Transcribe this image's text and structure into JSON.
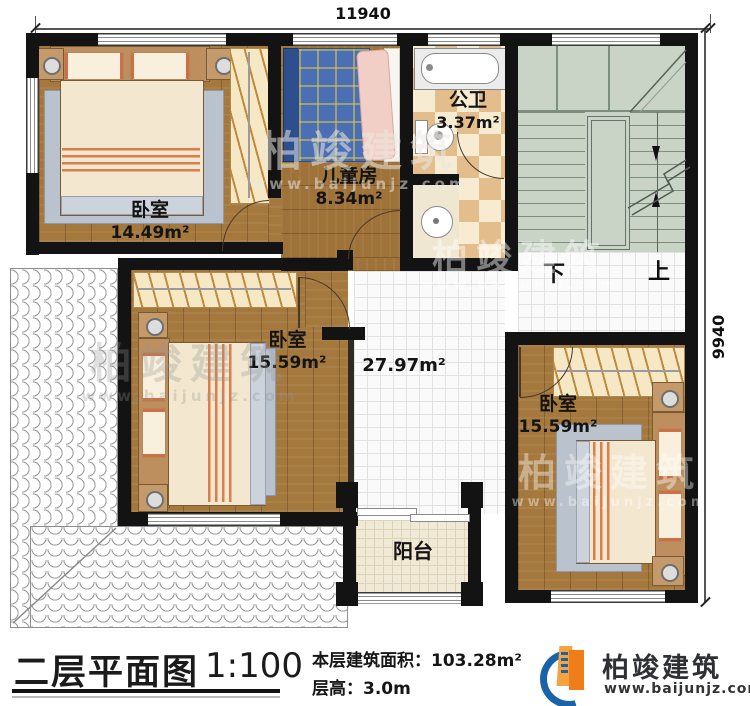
{
  "dimensions": {
    "top": "11940",
    "right": "9940"
  },
  "rooms": {
    "bedroom_top_left": {
      "name": "卧室",
      "area": "14.49m²"
    },
    "kids_room": {
      "name": "儿童房",
      "area": "8.34m²"
    },
    "bathroom": {
      "name": "公卫",
      "area": "3.37m²"
    },
    "bedroom_mid": {
      "name": "卧室",
      "area": "15.59m²"
    },
    "bedroom_right": {
      "name": "卧室",
      "area": "15.59m²"
    },
    "hall": {
      "area": "27.97m²"
    },
    "balcony": {
      "name": "阳台"
    },
    "stairs": {
      "down_label": "下",
      "up_label": "上"
    }
  },
  "title_block": {
    "title": "二层平面图",
    "scale": "1:100",
    "floor_area": "本层建筑面积：103.28m²",
    "floor_height": "层高：3.0m"
  },
  "brand": {
    "name": "柏竣建筑",
    "website": "www.baijunjz.com"
  },
  "watermark": {
    "name": "柏竣建筑",
    "url": "www.baijunjz.com"
  },
  "colors": {
    "wall": "#131313",
    "wood_floor": "#a5783e",
    "stair_floor": "#c9d3c6",
    "checker_dark": "#e3bd8c",
    "checker_light": "#f7ecd2",
    "balcony_floor": "#efe9d6",
    "brand_blue": "#1b63a8",
    "brand_orange": "#ef7d1a"
  }
}
